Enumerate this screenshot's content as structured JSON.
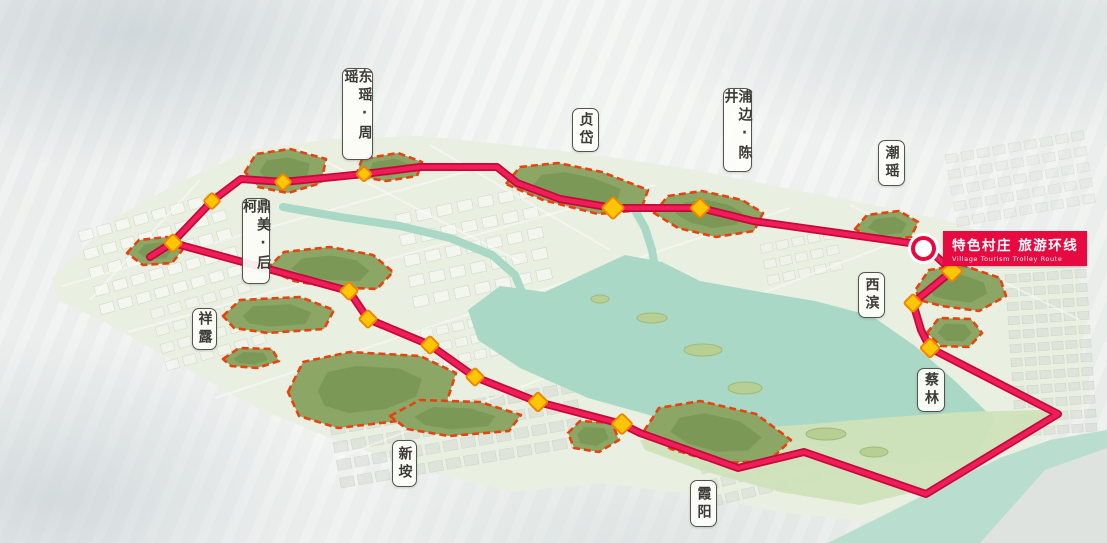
{
  "banner": {
    "zh": "特色村庄 旅游环线",
    "en": "Village Tourism Trolley Route",
    "bg_color": "#e60a41",
    "circle_x": 924,
    "circle_y": 245
  },
  "labels": [
    {
      "name": "dongyao-zhouyao",
      "text": "东瑶·周瑶",
      "x": 342,
      "y": 68,
      "w": 31,
      "h": 92
    },
    {
      "name": "zhendai",
      "text": "贞岱",
      "x": 572,
      "y": 108,
      "w": 27,
      "h": 44
    },
    {
      "name": "pubian-chenjing",
      "text": "浦边·陈井",
      "x": 723,
      "y": 88,
      "w": 29,
      "h": 84
    },
    {
      "name": "chaoyao",
      "text": "潮瑶",
      "x": 878,
      "y": 140,
      "w": 27,
      "h": 46
    },
    {
      "name": "dingmei-houke",
      "text": "鼎美·后柯",
      "x": 242,
      "y": 198,
      "w": 28,
      "h": 86
    },
    {
      "name": "xianglu",
      "text": "祥露",
      "x": 192,
      "y": 308,
      "w": 25,
      "h": 42
    },
    {
      "name": "xibin",
      "text": "西滨",
      "x": 858,
      "y": 272,
      "w": 27,
      "h": 46
    },
    {
      "name": "cailin",
      "text": "蔡林",
      "x": 917,
      "y": 368,
      "w": 28,
      "h": 44
    },
    {
      "name": "xinan",
      "text": "新垵",
      "x": 392,
      "y": 440,
      "w": 25,
      "h": 47
    },
    {
      "name": "xiayang",
      "text": "霞阳",
      "x": 690,
      "y": 480,
      "w": 27,
      "h": 47
    }
  ],
  "route": {
    "color": "#f01d5a",
    "casing_color": "#c30b38",
    "width": 4.5,
    "casing_width": 8,
    "points": [
      [
        150,
        257
      ],
      [
        172,
        243
      ],
      [
        212,
        201
      ],
      [
        241,
        179
      ],
      [
        283,
        182
      ],
      [
        334,
        177
      ],
      [
        364,
        174
      ],
      [
        420,
        167
      ],
      [
        497,
        167
      ],
      [
        517,
        183
      ],
      [
        560,
        199
      ],
      [
        613,
        208
      ],
      [
        700,
        208
      ],
      [
        753,
        221
      ],
      [
        860,
        236
      ],
      [
        924,
        245
      ],
      [
        952,
        271
      ],
      [
        913,
        303
      ],
      [
        921,
        330
      ],
      [
        930,
        348
      ],
      [
        1058,
        414
      ],
      [
        926,
        494
      ],
      [
        804,
        452
      ],
      [
        738,
        468
      ],
      [
        640,
        433
      ],
      [
        622,
        424
      ],
      [
        538,
        402
      ],
      [
        475,
        377
      ],
      [
        430,
        345
      ],
      [
        368,
        319
      ],
      [
        349,
        291
      ],
      [
        173,
        243
      ]
    ]
  },
  "nodes": {
    "fill": "#ffc608",
    "stroke": "#ee8600",
    "items": [
      [
        283,
        182,
        12
      ],
      [
        212,
        201,
        12
      ],
      [
        173,
        243,
        13
      ],
      [
        364,
        174,
        11
      ],
      [
        613,
        208,
        16
      ],
      [
        700,
        208,
        14
      ],
      [
        952,
        271,
        15
      ],
      [
        913,
        303,
        13
      ],
      [
        930,
        348,
        14
      ],
      [
        622,
        424,
        15
      ],
      [
        538,
        402,
        14
      ],
      [
        475,
        377,
        13
      ],
      [
        430,
        345,
        13
      ],
      [
        368,
        319,
        13
      ],
      [
        349,
        291,
        13
      ]
    ]
  },
  "villages": {
    "outline_color": "#e8430e",
    "fill_color": "#8ca765",
    "inner_color": "#6d8c4b",
    "areas": [
      {
        "name": "dongyao-zhouyao-area",
        "points": [
          [
            245,
            172
          ],
          [
            256,
            154
          ],
          [
            290,
            149
          ],
          [
            326,
            159
          ],
          [
            321,
            183
          ],
          [
            288,
            193
          ],
          [
            258,
            187
          ]
        ]
      },
      {
        "name": "zhouyao-west-area",
        "points": [
          [
            356,
            176
          ],
          [
            362,
            159
          ],
          [
            398,
            153
          ],
          [
            422,
            162
          ],
          [
            417,
            176
          ],
          [
            386,
            181
          ]
        ]
      },
      {
        "name": "zhendai-area",
        "points": [
          [
            506,
            184
          ],
          [
            520,
            167
          ],
          [
            558,
            163
          ],
          [
            602,
            172
          ],
          [
            648,
            190
          ],
          [
            641,
            210
          ],
          [
            598,
            214
          ],
          [
            543,
            200
          ]
        ]
      },
      {
        "name": "pubian-chenjing-area",
        "points": [
          [
            654,
            213
          ],
          [
            668,
            196
          ],
          [
            702,
            191
          ],
          [
            742,
            200
          ],
          [
            763,
            213
          ],
          [
            754,
            231
          ],
          [
            716,
            237
          ],
          [
            678,
            228
          ]
        ]
      },
      {
        "name": "chaoyao-area",
        "points": [
          [
            855,
            229
          ],
          [
            867,
            215
          ],
          [
            899,
            211
          ],
          [
            918,
            222
          ],
          [
            911,
            237
          ],
          [
            878,
            241
          ]
        ]
      },
      {
        "name": "xibin-area",
        "points": [
          [
            916,
            289
          ],
          [
            929,
            270
          ],
          [
            962,
            265
          ],
          [
            1000,
            278
          ],
          [
            1006,
            296
          ],
          [
            979,
            311
          ],
          [
            942,
            306
          ],
          [
            919,
            300
          ]
        ]
      },
      {
        "name": "cailin-area",
        "points": [
          [
            927,
            333
          ],
          [
            939,
            318
          ],
          [
            971,
            319
          ],
          [
            982,
            333
          ],
          [
            969,
            347
          ],
          [
            941,
            346
          ]
        ]
      },
      {
        "name": "west-village-area",
        "points": [
          [
            127,
            253
          ],
          [
            139,
            240
          ],
          [
            167,
            237
          ],
          [
            184,
            248
          ],
          [
            172,
            263
          ],
          [
            143,
            265
          ]
        ]
      },
      {
        "name": "dingmei-houke-area",
        "points": [
          [
            267,
            269
          ],
          [
            284,
            252
          ],
          [
            330,
            247
          ],
          [
            373,
            255
          ],
          [
            393,
            272
          ],
          [
            377,
            289
          ],
          [
            329,
            287
          ],
          [
            294,
            281
          ]
        ]
      },
      {
        "name": "xianglu-area",
        "points": [
          [
            223,
            316
          ],
          [
            240,
            300
          ],
          [
            300,
            297
          ],
          [
            334,
            310
          ],
          [
            324,
            329
          ],
          [
            268,
            333
          ],
          [
            234,
            328
          ]
        ]
      },
      {
        "name": "xianglu-south-area",
        "points": [
          [
            223,
            359
          ],
          [
            239,
            348
          ],
          [
            272,
            349
          ],
          [
            279,
            361
          ],
          [
            257,
            368
          ],
          [
            231,
            366
          ]
        ]
      },
      {
        "name": "xinan-main-area",
        "points": [
          [
            288,
            392
          ],
          [
            303,
            362
          ],
          [
            350,
            352
          ],
          [
            420,
            356
          ],
          [
            456,
            373
          ],
          [
            447,
            401
          ],
          [
            398,
            421
          ],
          [
            338,
            428
          ],
          [
            299,
            416
          ]
        ]
      },
      {
        "name": "xinan-east-area",
        "points": [
          [
            390,
            416
          ],
          [
            420,
            400
          ],
          [
            480,
            402
          ],
          [
            521,
            415
          ],
          [
            509,
            431
          ],
          [
            449,
            436
          ],
          [
            407,
            429
          ]
        ]
      },
      {
        "name": "xiayang-west-area",
        "points": [
          [
            568,
            433
          ],
          [
            580,
            421
          ],
          [
            612,
            423
          ],
          [
            619,
            440
          ],
          [
            599,
            452
          ],
          [
            574,
            448
          ]
        ]
      },
      {
        "name": "xiayang-area",
        "points": [
          [
            644,
            431
          ],
          [
            659,
            408
          ],
          [
            700,
            401
          ],
          [
            756,
            414
          ],
          [
            791,
            440
          ],
          [
            769,
            461
          ],
          [
            718,
            463
          ],
          [
            671,
            449
          ]
        ]
      }
    ]
  },
  "water": {
    "color": "#a9d8c7",
    "sea_color": "#b9ddcf",
    "lake": [
      [
        468,
        310
      ],
      [
        500,
        286
      ],
      [
        545,
        292
      ],
      [
        588,
        272
      ],
      [
        625,
        255
      ],
      [
        662,
        262
      ],
      [
        700,
        281
      ],
      [
        755,
        291
      ],
      [
        815,
        301
      ],
      [
        872,
        316
      ],
      [
        915,
        346
      ],
      [
        955,
        381
      ],
      [
        995,
        420
      ],
      [
        975,
        458
      ],
      [
        905,
        465
      ],
      [
        830,
        448
      ],
      [
        745,
        428
      ],
      [
        660,
        418
      ],
      [
        588,
        398
      ],
      [
        520,
        368
      ],
      [
        478,
        340
      ]
    ],
    "sea": [
      [
        828,
        543
      ],
      [
        930,
        492
      ],
      [
        1000,
        458
      ],
      [
        1050,
        440
      ],
      [
        1107,
        430
      ],
      [
        1107,
        543
      ]
    ],
    "rivers": [
      [
        [
          283,
          207
        ],
        [
          340,
          217
        ],
        [
          400,
          226
        ],
        [
          450,
          238
        ],
        [
          492,
          255
        ],
        [
          515,
          275
        ],
        [
          522,
          292
        ]
      ],
      [
        [
          618,
          186
        ],
        [
          632,
          205
        ],
        [
          645,
          228
        ],
        [
          652,
          250
        ],
        [
          655,
          268
        ]
      ]
    ],
    "islands": [
      [
        652,
        318,
        15,
        5
      ],
      [
        703,
        350,
        19,
        6
      ],
      [
        745,
        388,
        17,
        6
      ],
      [
        600,
        299,
        9,
        4
      ],
      [
        826,
        434,
        20,
        6
      ],
      [
        874,
        452,
        14,
        5
      ]
    ]
  },
  "terrain": {
    "land_color": "#e9efe1",
    "peninsula_color": "#cfe2ba",
    "far_shore_color": "#dfe3df",
    "land": [
      [
        52,
        278
      ],
      [
        115,
        218
      ],
      [
        180,
        182
      ],
      [
        250,
        150
      ],
      [
        330,
        139
      ],
      [
        420,
        136
      ],
      [
        520,
        146
      ],
      [
        610,
        157
      ],
      [
        700,
        171
      ],
      [
        790,
        189
      ],
      [
        868,
        204
      ],
      [
        948,
        221
      ],
      [
        1018,
        243
      ],
      [
        1072,
        266
      ],
      [
        1090,
        300
      ],
      [
        1082,
        345
      ],
      [
        1090,
        398
      ],
      [
        1062,
        428
      ],
      [
        1002,
        468
      ],
      [
        932,
        505
      ],
      [
        868,
        522
      ],
      [
        780,
        512
      ],
      [
        690,
        494
      ],
      [
        600,
        483
      ],
      [
        510,
        492
      ],
      [
        430,
        472
      ],
      [
        340,
        442
      ],
      [
        255,
        407
      ],
      [
        175,
        362
      ],
      [
        105,
        322
      ],
      [
        58,
        300
      ]
    ],
    "peninsula": [
      [
        640,
        440
      ],
      [
        720,
        430
      ],
      [
        800,
        425
      ],
      [
        880,
        418
      ],
      [
        960,
        412
      ],
      [
        1040,
        410
      ],
      [
        1062,
        416
      ],
      [
        1000,
        452
      ],
      [
        930,
        488
      ],
      [
        860,
        505
      ],
      [
        780,
        492
      ],
      [
        700,
        470
      ],
      [
        645,
        450
      ]
    ],
    "far_shore": [
      [
        1045,
        470
      ],
      [
        1107,
        448
      ],
      [
        1107,
        543
      ],
      [
        980,
        543
      ]
    ]
  },
  "districts": [
    {
      "x": 78,
      "y": 232,
      "w": 150,
      "h": 100,
      "rot": -16,
      "cell": 14,
      "gap": 5,
      "fill": "#fdfdfb",
      "op": 0.55
    },
    {
      "x": 150,
      "y": 310,
      "w": 110,
      "h": 70,
      "rot": -16,
      "cell": 13,
      "gap": 5,
      "fill": "#f6f8f3",
      "op": 0.5
    },
    {
      "x": 395,
      "y": 215,
      "w": 150,
      "h": 115,
      "rot": -12,
      "cell": 15,
      "gap": 6,
      "fill": "#fbfcf9",
      "op": 0.55
    },
    {
      "x": 420,
      "y": 330,
      "w": 80,
      "h": 55,
      "rot": -12,
      "cell": 12,
      "gap": 4,
      "fill": "#f7f9f5",
      "op": 0.5
    },
    {
      "x": 330,
      "y": 425,
      "w": 250,
      "h": 70,
      "rot": -10,
      "cell": 14,
      "gap": 4,
      "fill": "#d9ded8",
      "op": 0.6
    },
    {
      "x": 700,
      "y": 465,
      "w": 170,
      "h": 55,
      "rot": -14,
      "cell": 13,
      "gap": 4,
      "fill": "#d9ded8",
      "op": 0.55
    },
    {
      "x": 1005,
      "y": 275,
      "w": 95,
      "h": 175,
      "rot": -4,
      "cell": 11,
      "gap": 3,
      "fill": "#d8ddd7",
      "op": 0.6
    },
    {
      "x": 945,
      "y": 155,
      "w": 145,
      "h": 80,
      "rot": -10,
      "cell": 12,
      "gap": 4,
      "fill": "#e2e6e2",
      "op": 0.45
    },
    {
      "x": 760,
      "y": 245,
      "w": 85,
      "h": 55,
      "rot": -12,
      "cell": 12,
      "gap": 4,
      "fill": "#f4f6f1",
      "op": 0.5
    }
  ],
  "roads": [
    [
      62,
      286,
      500,
      162
    ],
    [
      128,
      332,
      655,
      185
    ],
    [
      215,
      398,
      790,
      208
    ],
    [
      338,
      458,
      905,
      238
    ],
    [
      300,
      148,
      520,
      262
    ],
    [
      430,
      145,
      610,
      250
    ],
    [
      850,
      205,
      1080,
      320
    ],
    [
      200,
      180,
      90,
      300
    ]
  ]
}
